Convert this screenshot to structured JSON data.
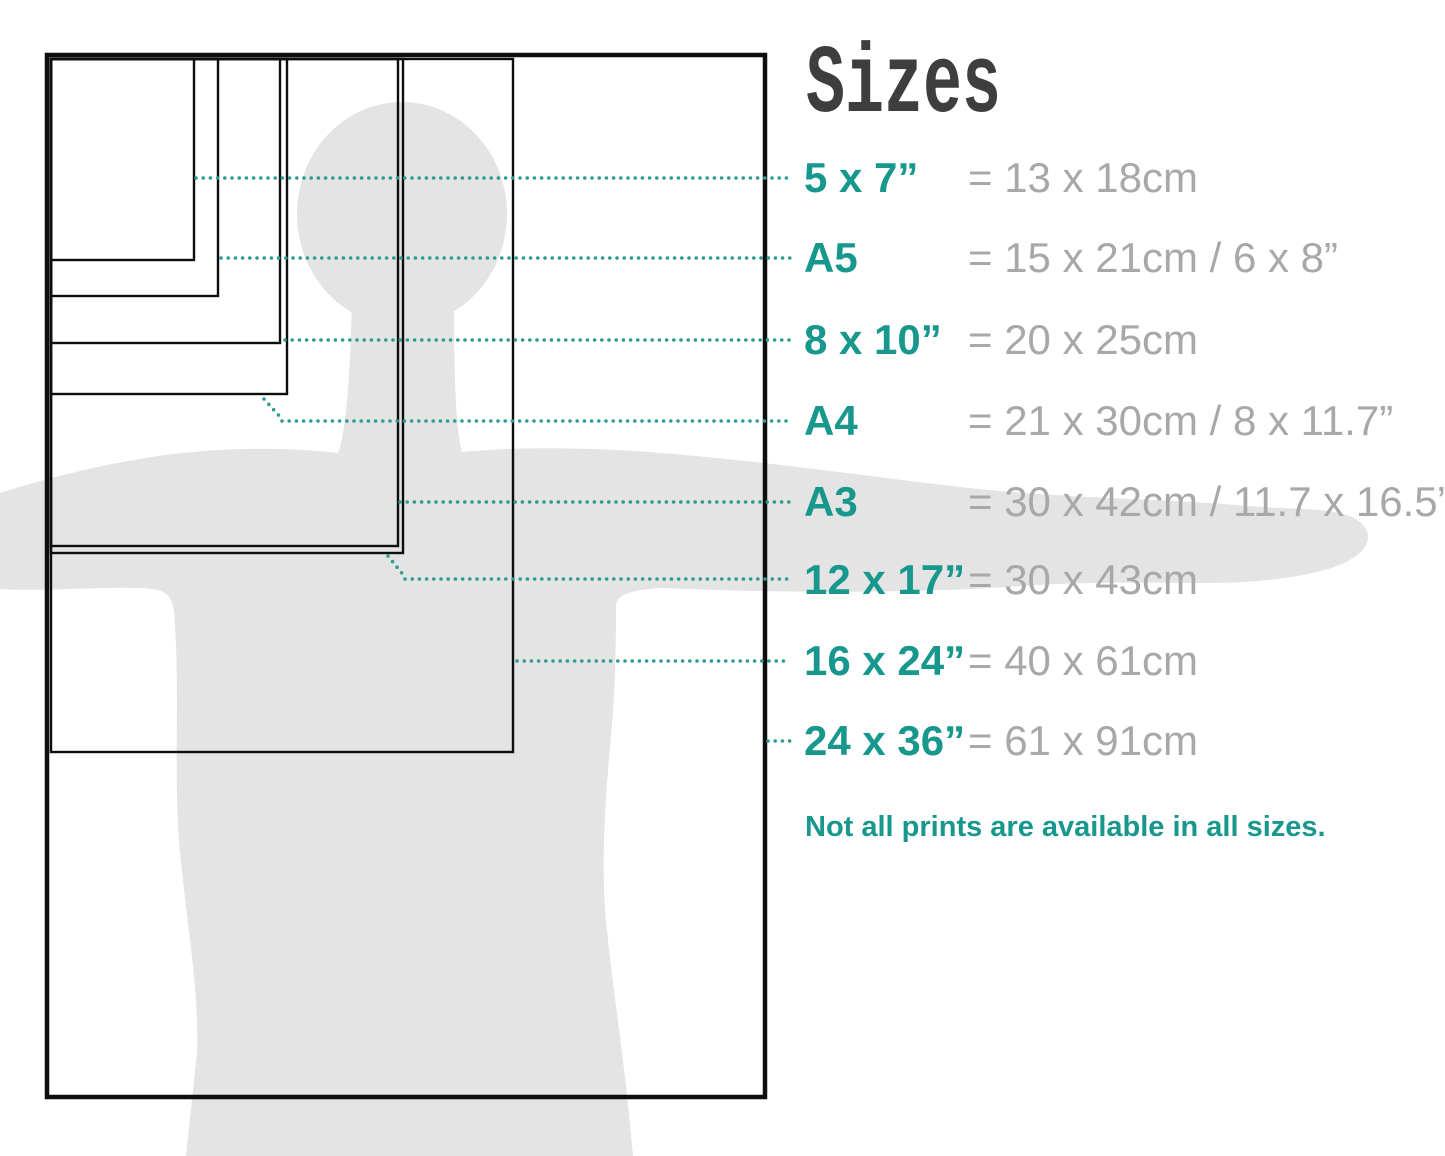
{
  "title": "Sizes",
  "sizes": [
    {
      "id": "5x7",
      "label": "5 x 7”",
      "metric": "= 13 x 18cm"
    },
    {
      "id": "a5",
      "label": "A5",
      "metric": "= 15 x 21cm / 6 x 8”"
    },
    {
      "id": "8x10",
      "label": "8 x 10”",
      "metric": "= 20 x 25cm"
    },
    {
      "id": "a4",
      "label": "A4",
      "metric": "= 21 x 30cm / 8 x 11.7”"
    },
    {
      "id": "a3",
      "label": "A3",
      "metric": "= 30 x 42cm / 11.7 x 16.5”"
    },
    {
      "id": "12x17",
      "label": "12 x 17”",
      "metric": "= 30 x 43cm"
    },
    {
      "id": "16x24",
      "label": "16 x 24”",
      "metric": "= 40 x 61cm"
    },
    {
      "id": "24x36",
      "label": "24 x 36”",
      "metric": "= 61 x 91cm"
    }
  ],
  "note": "Not all prints are available in all sizes.",
  "colors": {
    "accent": "#18978d",
    "dots": "#2f9b92",
    "metric_text": "#a8a8a8",
    "title_text": "#3e3e3e",
    "silhouette": "#e4e4e4",
    "frame": "#0e0e0e",
    "background": "#ffffff"
  }
}
